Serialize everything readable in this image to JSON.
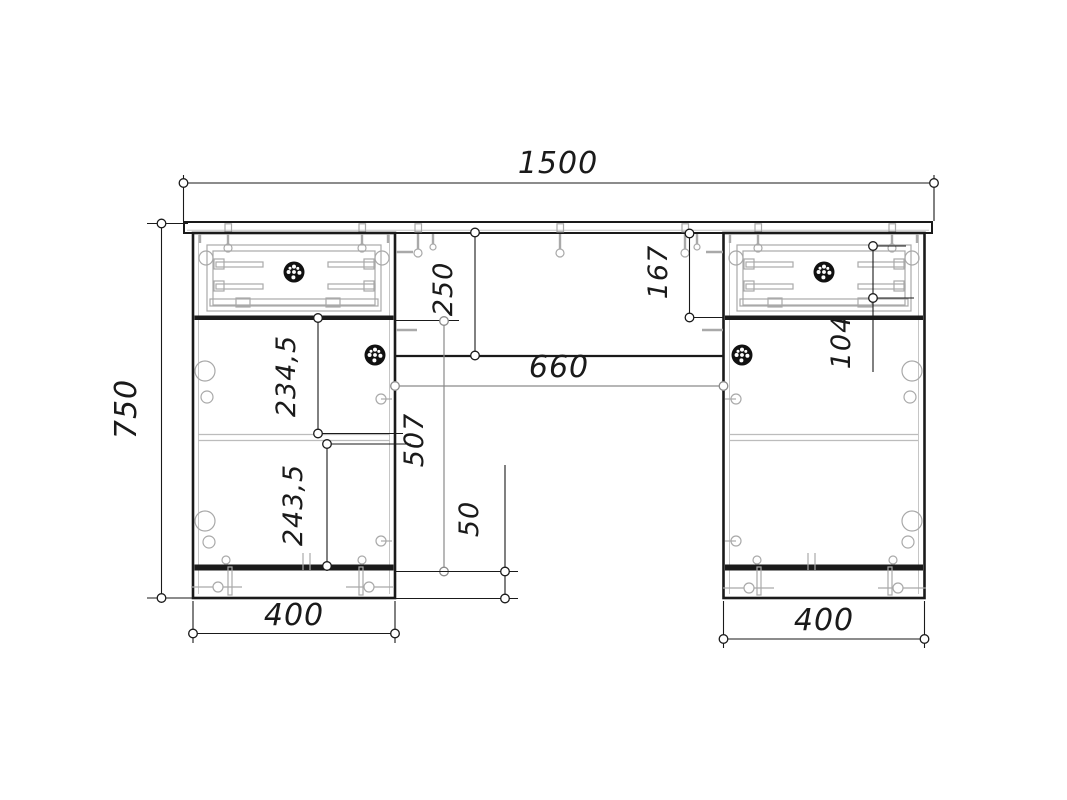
{
  "drawing": {
    "view": "furniture-assembly-front-elevation",
    "dim": {
      "overall_width": "1500",
      "overall_height": "750",
      "pedestal_width_left": "400",
      "pedestal_width_right": "400",
      "knee_space_width": "660",
      "apron_drop": "250",
      "door_section_height": "507",
      "plinth_height": "50",
      "upper_compartment_height": "234,5",
      "lower_compartment_height": "243,5",
      "drawer_space_height": "167",
      "drawer_inner_height": "104"
    },
    "colors": {
      "line": "#1a1a1a",
      "hardware": "#a9a9a9",
      "dim_secondary": "#8a8a8a",
      "background": "#ffffff"
    },
    "icons": {
      "knob": "knob-icon",
      "hinge": "hinge-icon",
      "screw": "screw-icon",
      "dim_endpoint": "dimension-endpoint-icon"
    }
  }
}
